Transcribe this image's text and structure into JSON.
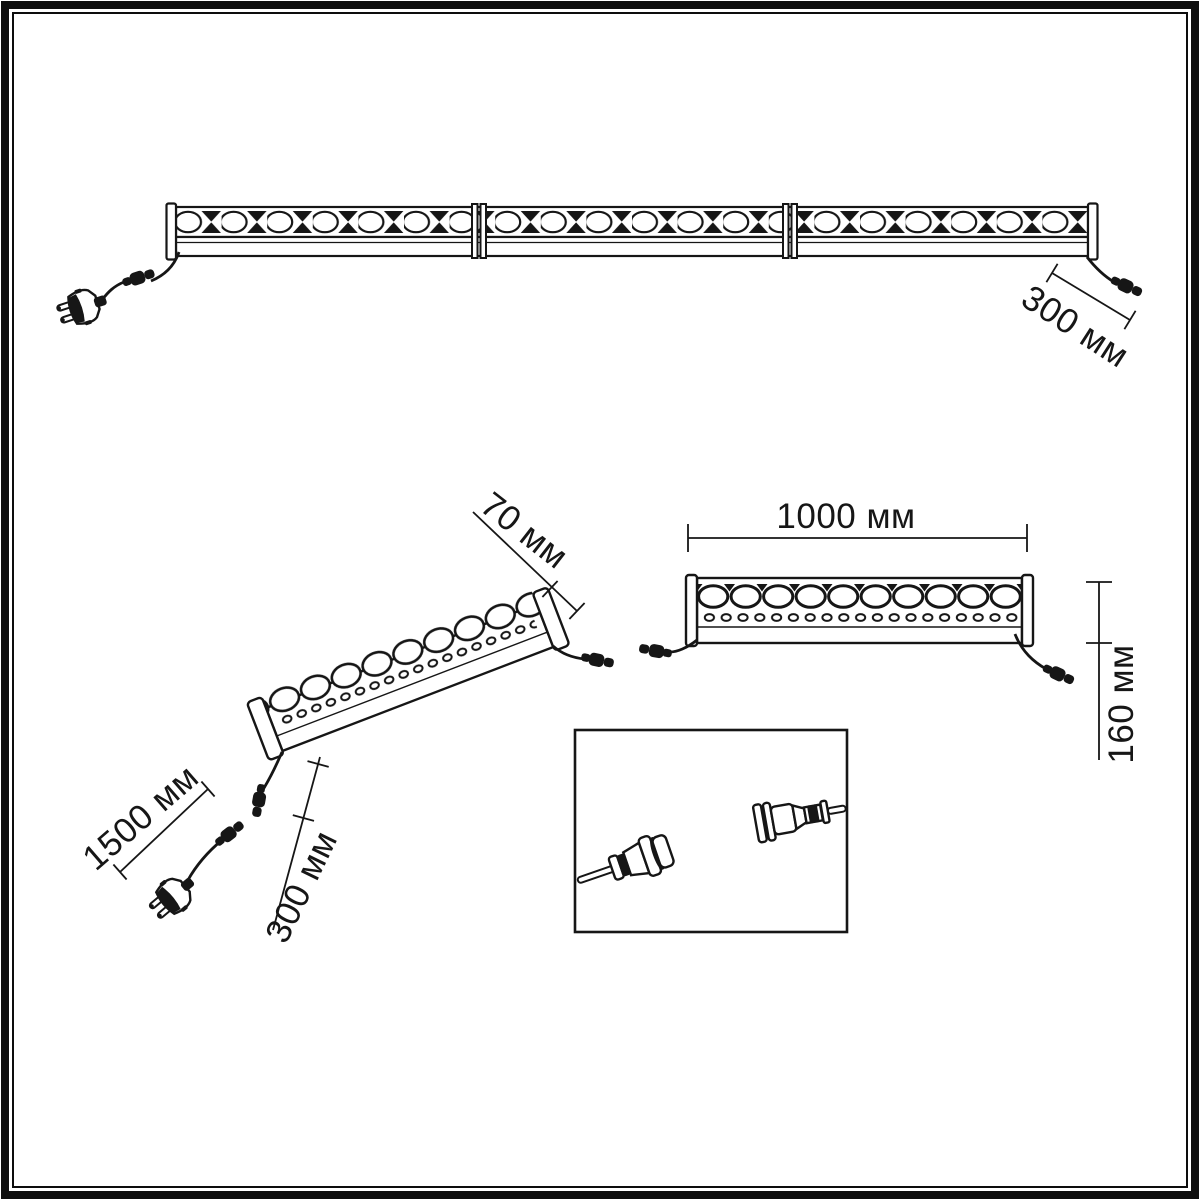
{
  "canvas": {
    "background_color": "#ffffff",
    "line_color": "#161616"
  },
  "dimensions": {
    "top_end_cable_length": "300 мм",
    "bar_depth": "70 мм",
    "bar_length": "1000 мм",
    "bar_height": "160 мм",
    "power_cord_length": "1500 мм",
    "side_cable_length": "300 мм"
  }
}
